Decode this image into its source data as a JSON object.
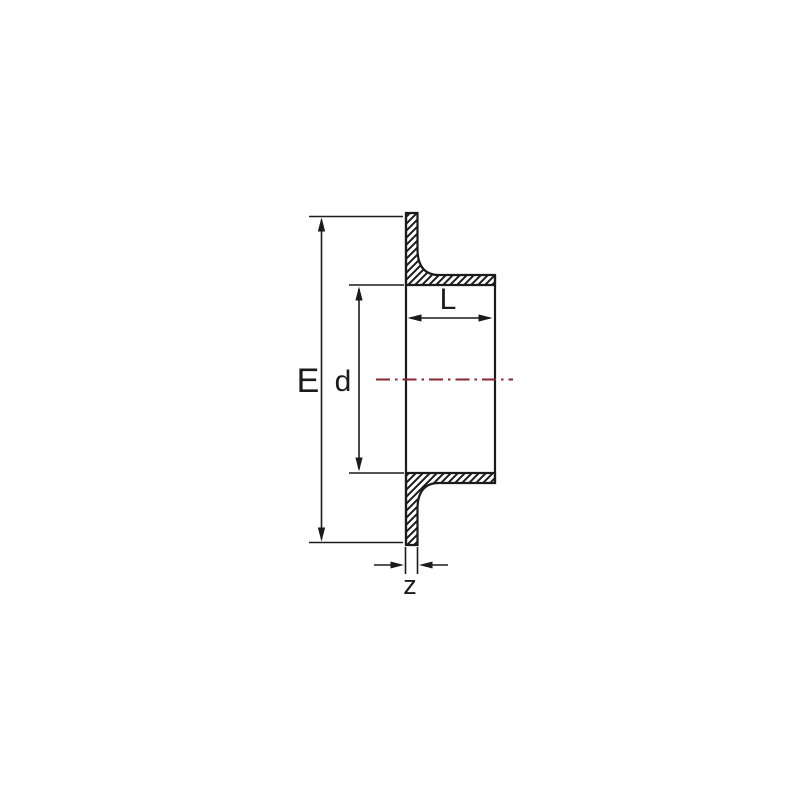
{
  "diagram": {
    "title": "Stub flange cross-section technical drawing",
    "labels": {
      "E": "E",
      "d": "d",
      "L": "L",
      "z": "z"
    },
    "colors": {
      "outline": "#1b1b1b",
      "dimension": "#1b1b1b",
      "centerline": "#8c2434",
      "background": "#ffffff"
    }
  }
}
